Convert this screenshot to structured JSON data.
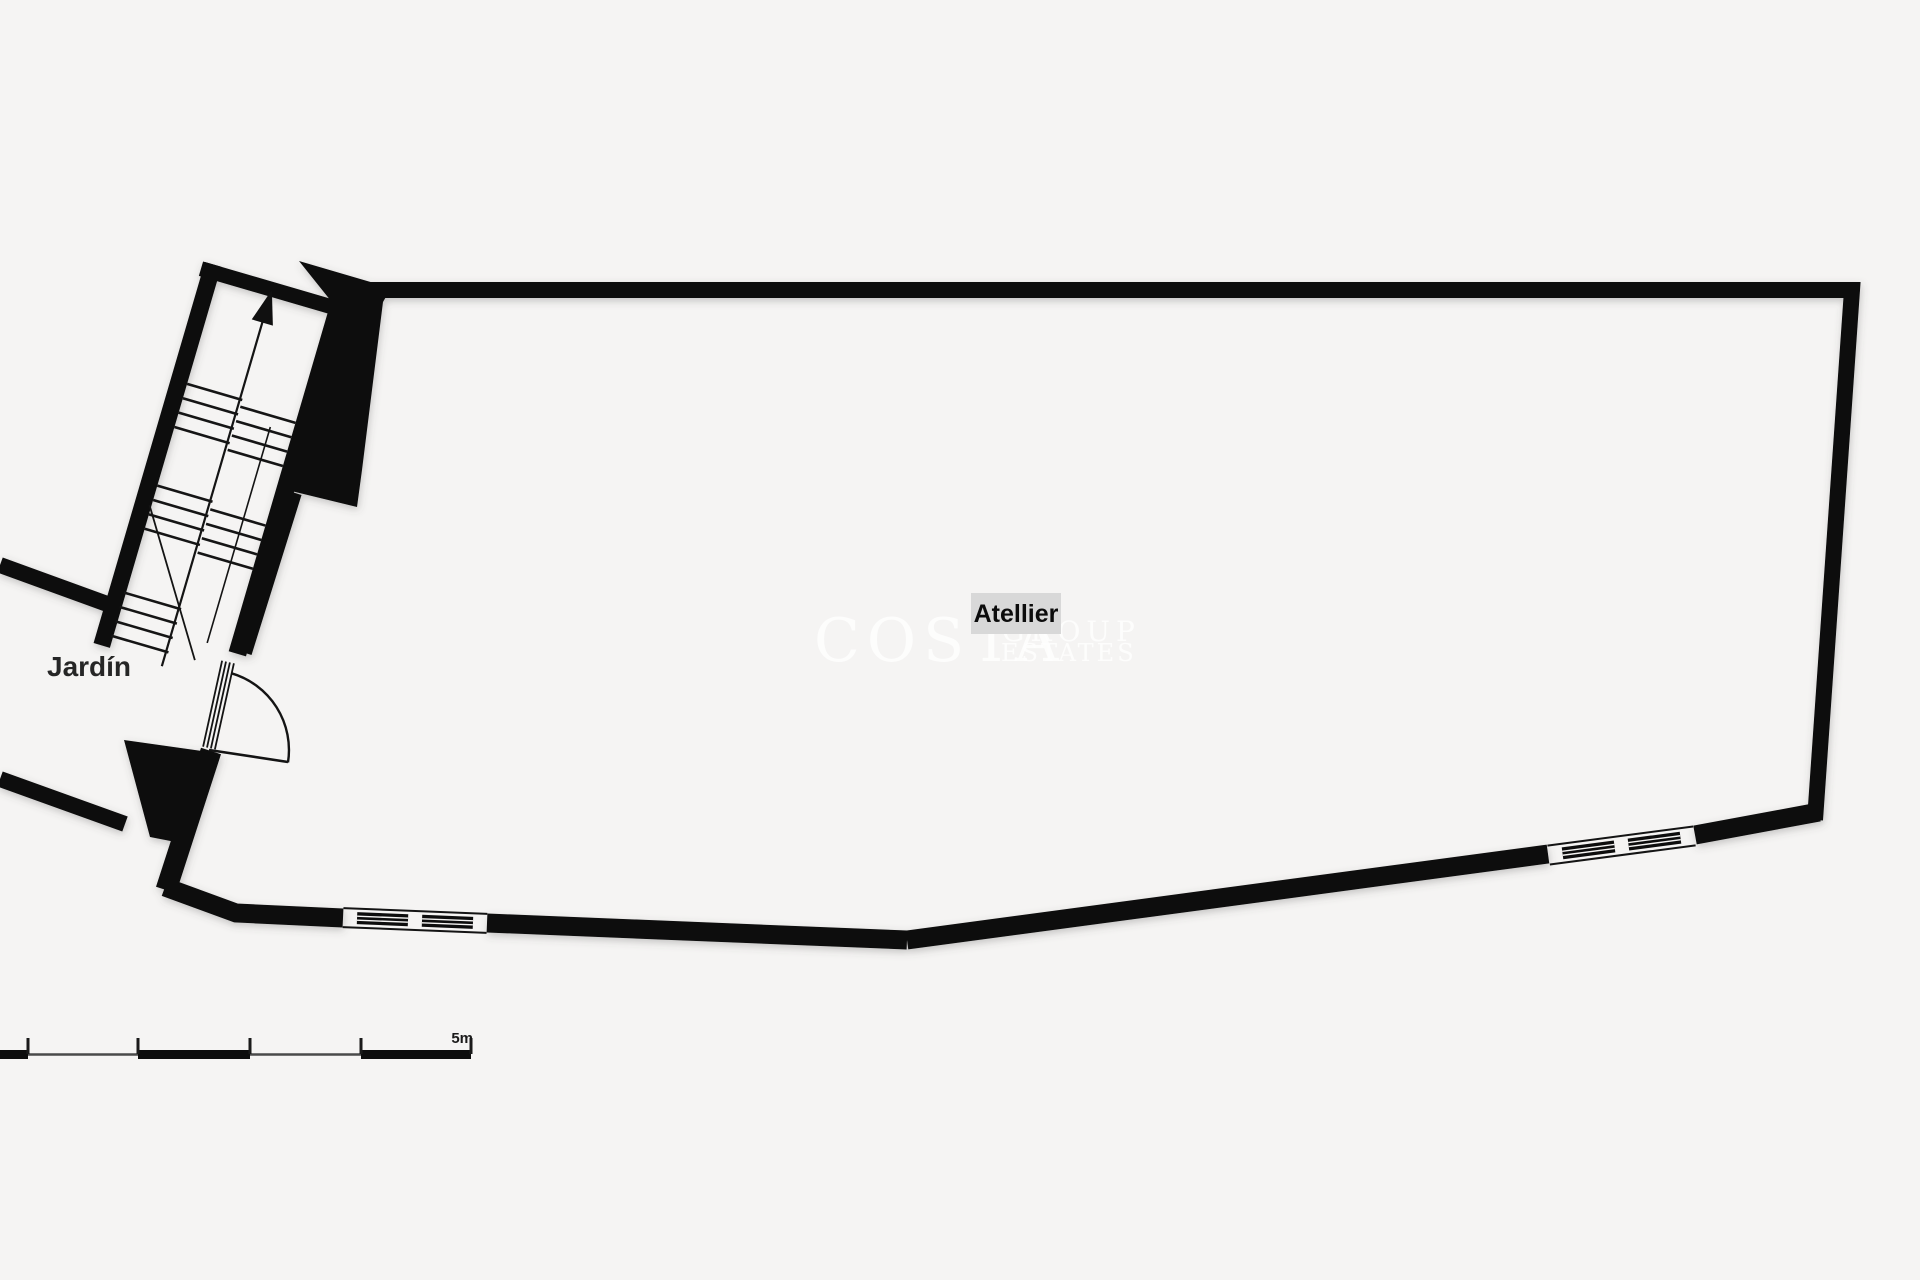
{
  "page": {
    "type": "floor-plan",
    "background_color": "#f5f4f3"
  },
  "plan": {
    "labels": {
      "atelier": "Atellier",
      "garden": "Jardín"
    },
    "scale_bar": {
      "label": "5m",
      "segments": 5
    },
    "watermark": {
      "word1": "COSTA",
      "word2": "GROUP",
      "word3": "ESTATES"
    },
    "symbols": {
      "stair_direction": "up-arrow",
      "door": "quarter-circle-swing",
      "windows": 2
    },
    "colors": {
      "wall": "#0a0a0a",
      "label_background": "#d8d8d8",
      "text": "#1e1e1e",
      "watermark": "#ffffff",
      "background": "#f5f4f3"
    }
  }
}
